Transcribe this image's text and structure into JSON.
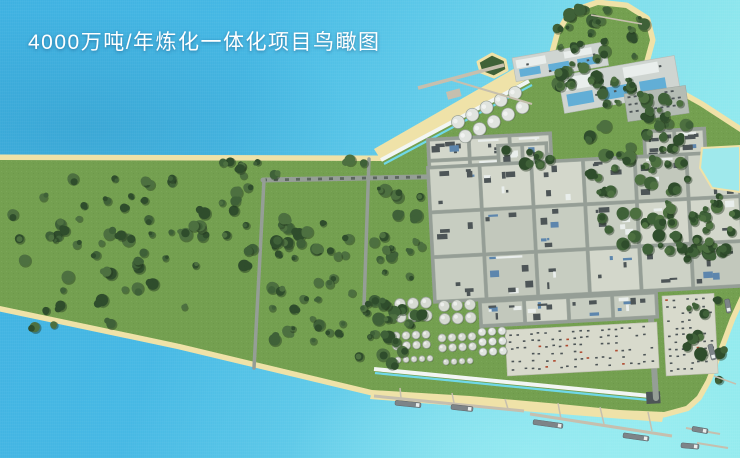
{
  "title": "4000万吨/年炼化一体化项目鸟瞰图",
  "scene": {
    "colors": {
      "water_deep": "#3eb1e1",
      "water_mid": "#5cc8e8",
      "water_light": "#93eaee",
      "sand": "#efe2a8",
      "grass": "#74a050",
      "grass_light": "#8fc05b",
      "tree_dark": "#2f4d2c",
      "tree_mid": "#3f6138",
      "tree_light": "#4d7040",
      "tree_shadow": "#24381f",
      "road": "#959e96",
      "road_dark": "#5c665f",
      "block_base": "#c7cdc1",
      "block_dark": "#4d5557",
      "block_white": "#e9eeec",
      "block_blue": "#5d86ad",
      "pool_blue": "#62aed6",
      "utility_base": "#cfd5d1",
      "parking_base": "#b4bcb4",
      "yard_base": "#d8dacc",
      "tank_fill": "#d6dad2",
      "tank_stroke": "#98a198",
      "sphere_fill": "#e0e4df",
      "pier_tan": "#c6bfae",
      "ship_gray": "#7d8488",
      "canal_white": "#f2f6f4",
      "canal_cyan": "#6fd8e8",
      "pond": "#9fe9ec",
      "accent_red": "#b04a30",
      "title_color": "#ffffff"
    },
    "land": {
      "outline": [
        [
          0,
          160
        ],
        [
          383,
          161
        ],
        [
          540,
          72
        ],
        [
          554,
          56
        ],
        [
          560,
          34
        ],
        [
          572,
          14
        ],
        [
          598,
          5
        ],
        [
          626,
          8
        ],
        [
          645,
          20
        ],
        [
          650,
          40
        ],
        [
          644,
          62
        ],
        [
          652,
          78
        ],
        [
          668,
          88
        ],
        [
          700,
          106
        ],
        [
          740,
          132
        ],
        [
          740,
          296
        ],
        [
          730,
          318
        ],
        [
          718,
          350
        ],
        [
          706,
          380
        ],
        [
          697,
          396
        ],
        [
          686,
          406
        ],
        [
          664,
          412
        ],
        [
          620,
          410
        ],
        [
          560,
          404
        ],
        [
          470,
          396
        ],
        [
          372,
          390
        ],
        [
          180,
          344
        ],
        [
          0,
          306
        ]
      ],
      "beaches": [
        {
          "name": "north-diagonal-beach",
          "points": [
            [
              383,
              163
            ],
            [
              540,
              73
            ],
            [
              531,
              59
            ],
            [
              374,
              149
            ]
          ]
        },
        {
          "name": "south-beach",
          "points": [
            [
              372,
              391
            ],
            [
              664,
              414
            ],
            [
              662,
              422
            ],
            [
              370,
              399
            ]
          ]
        }
      ],
      "pond": [
        [
          702,
          148
        ],
        [
          740,
          146
        ],
        [
          740,
          192
        ],
        [
          712,
          188
        ],
        [
          700,
          168
        ]
      ],
      "island": [
        [
          478,
          62
        ],
        [
          492,
          54
        ],
        [
          505,
          60
        ],
        [
          507,
          70
        ],
        [
          494,
          77
        ],
        [
          481,
          72
        ]
      ],
      "lawn": [
        [
          550,
          168
        ],
        [
          590,
          160
        ],
        [
          568,
          196
        ],
        [
          552,
          186
        ]
      ],
      "seawalls": [
        {
          "name": "north-seawall",
          "white": [
            [
              381,
              160
            ],
            [
              529,
              81
            ]
          ],
          "cyan": [
            [
              384,
              164
            ],
            [
              532,
              85
            ]
          ]
        },
        {
          "name": "south-revetment",
          "white": [
            [
              374,
              369
            ],
            [
              660,
              397
            ]
          ],
          "cyan": [
            [
              375,
              373
            ],
            [
              659,
              401
            ]
          ]
        }
      ],
      "canal_end": {
        "x": 646,
        "y": 392,
        "w": 14,
        "h": 12,
        "rot": -3
      }
    },
    "roads": [
      {
        "name": "pipeline-corridor",
        "pts": [
          [
            263,
            180
          ],
          [
            740,
            171
          ]
        ],
        "w": 5,
        "dashed": true
      },
      {
        "name": "west-parcel-road",
        "pts": [
          [
            264,
            180
          ],
          [
            254,
            368
          ]
        ],
        "w": 3.5
      },
      {
        "name": "mid-parcel-road",
        "pts": [
          [
            369,
            159
          ],
          [
            364,
            306
          ]
        ],
        "w": 3.5
      },
      {
        "name": "south-main-road",
        "pts": [
          [
            650,
            302
          ],
          [
            656,
            398
          ]
        ],
        "w": 6
      }
    ],
    "districts": [
      {
        "name": "north-plant-row",
        "type": "blocks",
        "x": 426,
        "y": 138,
        "w": 126,
        "h": 46,
        "rows": 2,
        "cols": 3,
        "rot": -3
      },
      {
        "name": "water-treatment-pad-a",
        "type": "utility",
        "x": 512,
        "y": 58,
        "w": 94,
        "h": 24,
        "rot": -10
      },
      {
        "name": "water-treatment-pad-b",
        "type": "utility",
        "x": 558,
        "y": 76,
        "w": 118,
        "h": 38,
        "rot": -10
      },
      {
        "name": "parking-lot",
        "type": "parking",
        "x": 624,
        "y": 94,
        "w": 62,
        "h": 28,
        "rot": -8
      },
      {
        "name": "office-blocks",
        "type": "blocks",
        "x": 496,
        "y": 144,
        "w": 52,
        "h": 32,
        "rows": 1,
        "cols": 2,
        "rot": -3
      },
      {
        "name": "east-blocks",
        "type": "blocks",
        "x": 642,
        "y": 130,
        "w": 64,
        "h": 32,
        "rows": 1,
        "cols": 2,
        "rot": -3
      },
      {
        "name": "main-process-grid",
        "type": "blocks",
        "x": 426,
        "y": 166,
        "w": 314,
        "h": 138,
        "rows": 3,
        "cols": 6,
        "rot": -3
      },
      {
        "name": "south-blocks-row",
        "type": "blocks",
        "x": 478,
        "y": 300,
        "w": 180,
        "h": 28,
        "rows": 1,
        "cols": 4,
        "rot": -3
      },
      {
        "name": "laydown-yard",
        "type": "yard",
        "x": 505,
        "y": 330,
        "w": 152,
        "h": 46,
        "rot": -3
      },
      {
        "name": "east-yard",
        "type": "yard",
        "x": 662,
        "y": 296,
        "w": 52,
        "h": 80,
        "rot": -3
      }
    ],
    "tanks": [
      {
        "name": "sphere-tanks-north",
        "cx": 458,
        "cy": 122,
        "rows": 2,
        "cols": 5,
        "r": 6.5,
        "gap": 16,
        "rot": -27,
        "sphere": true
      },
      {
        "name": "tank-farm-a",
        "cx": 400,
        "cy": 304,
        "rows": 2,
        "cols": 3,
        "r": 5.5,
        "gap": 13,
        "rot": -3
      },
      {
        "name": "tank-farm-b",
        "cx": 444,
        "cy": 306,
        "rows": 2,
        "cols": 3,
        "r": 5.5,
        "gap": 13,
        "rot": -3
      },
      {
        "name": "tank-farm-c",
        "cx": 396,
        "cy": 336,
        "rows": 2,
        "cols": 4,
        "r": 4,
        "gap": 10,
        "rot": -3
      },
      {
        "name": "tank-farm-d",
        "cx": 442,
        "cy": 338,
        "rows": 2,
        "cols": 4,
        "r": 4,
        "gap": 10,
        "rot": -3
      },
      {
        "name": "tank-farm-e",
        "cx": 482,
        "cy": 332,
        "rows": 3,
        "cols": 3,
        "r": 4,
        "gap": 10,
        "rot": -3,
        "sphere": true
      },
      {
        "name": "tank-row-f",
        "cx": 398,
        "cy": 360,
        "rows": 1,
        "cols": 5,
        "r": 3,
        "gap": 8,
        "rot": -3
      },
      {
        "name": "tank-row-g",
        "cx": 446,
        "cy": 362,
        "rows": 1,
        "cols": 4,
        "r": 3,
        "gap": 8,
        "rot": -3
      }
    ],
    "trees": [
      {
        "name": "west-forest",
        "x": 12,
        "y": 166,
        "w": 242,
        "h": 108,
        "n": 56
      },
      {
        "name": "west-sparse",
        "x": 30,
        "y": 274,
        "w": 168,
        "h": 58,
        "n": 12
      },
      {
        "name": "mid-forest",
        "x": 272,
        "y": 182,
        "w": 90,
        "h": 162,
        "n": 38
      },
      {
        "name": "east-parcel-forest",
        "x": 374,
        "y": 184,
        "w": 50,
        "h": 168,
        "n": 30
      },
      {
        "name": "coast-strip",
        "x": 222,
        "y": 160,
        "w": 150,
        "h": 16,
        "n": 9
      },
      {
        "name": "headland-forest",
        "x": 556,
        "y": 8,
        "w": 92,
        "h": 82,
        "n": 42
      },
      {
        "name": "central-forest",
        "x": 586,
        "y": 92,
        "w": 102,
        "h": 88,
        "n": 40
      },
      {
        "name": "central-forest-south",
        "x": 598,
        "y": 176,
        "w": 78,
        "h": 76,
        "n": 24
      },
      {
        "name": "east-forest",
        "x": 656,
        "y": 204,
        "w": 68,
        "h": 56,
        "n": 16
      },
      {
        "name": "right-edge-forest",
        "x": 692,
        "y": 196,
        "w": 46,
        "h": 66,
        "n": 14
      },
      {
        "name": "tankfarm-strip",
        "x": 352,
        "y": 298,
        "w": 42,
        "h": 74,
        "n": 12
      },
      {
        "name": "north-pocket",
        "x": 500,
        "y": 148,
        "w": 50,
        "h": 20,
        "n": 7
      },
      {
        "name": "right-coast-strip",
        "x": 686,
        "y": 300,
        "w": 34,
        "h": 82,
        "n": 10
      }
    ],
    "piers": [
      {
        "name": "north-jetty-head",
        "pts": [
          [
            418,
            88
          ],
          [
            504,
            65
          ]
        ],
        "w": 3.5
      },
      {
        "name": "north-jetty-trestle",
        "pts": [
          [
            532,
            104
          ],
          [
            452,
            80
          ]
        ],
        "w": 2
      },
      {
        "name": "headland-spit",
        "pts": [
          [
            591,
            15
          ],
          [
            642,
            24
          ]
        ],
        "w": 1.5
      },
      {
        "name": "south-pier-west",
        "pts": [
          [
            374,
            396
          ],
          [
            524,
            411
          ]
        ],
        "w": 3
      },
      {
        "name": "sp-west-trestle-1",
        "pts": [
          [
            400,
            388
          ],
          [
            401,
            398
          ]
        ],
        "w": 1.5
      },
      {
        "name": "sp-west-trestle-2",
        "pts": [
          [
            452,
            393
          ],
          [
            454,
            403
          ]
        ],
        "w": 1.5
      },
      {
        "name": "sp-west-trestle-3",
        "pts": [
          [
            505,
            399
          ],
          [
            508,
            409
          ]
        ],
        "w": 1.5
      },
      {
        "name": "south-pier-east",
        "pts": [
          [
            530,
            414
          ],
          [
            672,
            436
          ]
        ],
        "w": 3
      },
      {
        "name": "sp-east-trestle-1",
        "pts": [
          [
            558,
            403
          ],
          [
            561,
            419
          ]
        ],
        "w": 1.5
      },
      {
        "name": "sp-east-trestle-2",
        "pts": [
          [
            600,
            407
          ],
          [
            604,
            424
          ]
        ],
        "w": 1.5
      },
      {
        "name": "sp-east-trestle-3",
        "pts": [
          [
            648,
            412
          ],
          [
            652,
            431
          ]
        ],
        "w": 1.5
      },
      {
        "name": "corner-pier-a",
        "pts": [
          [
            686,
            428
          ],
          [
            720,
            434
          ]
        ],
        "w": 2
      },
      {
        "name": "corner-pier-b",
        "pts": [
          [
            697,
            443
          ],
          [
            728,
            448
          ]
        ],
        "w": 2
      },
      {
        "name": "east-coast-pier",
        "pts": [
          [
            714,
            376
          ],
          [
            736,
            384
          ]
        ],
        "w": 1.5
      }
    ],
    "berths": [
      {
        "name": "jetty-berth-platform",
        "x": 446,
        "y": 92,
        "w": 14,
        "h": 8,
        "rot": -15
      }
    ],
    "ships": [
      {
        "x": 408,
        "y": 404,
        "rot": 6,
        "len": 26
      },
      {
        "x": 462,
        "y": 408,
        "rot": 6,
        "len": 22
      },
      {
        "x": 548,
        "y": 424,
        "rot": 8,
        "len": 30
      },
      {
        "x": 636,
        "y": 437,
        "rot": 8,
        "len": 26
      },
      {
        "x": 700,
        "y": 430,
        "rot": 10,
        "len": 16
      },
      {
        "x": 712,
        "y": 352,
        "rot": 75,
        "len": 16
      },
      {
        "x": 728,
        "y": 306,
        "rot": 80,
        "len": 14
      },
      {
        "x": 690,
        "y": 446,
        "rot": 5,
        "len": 18
      }
    ]
  }
}
